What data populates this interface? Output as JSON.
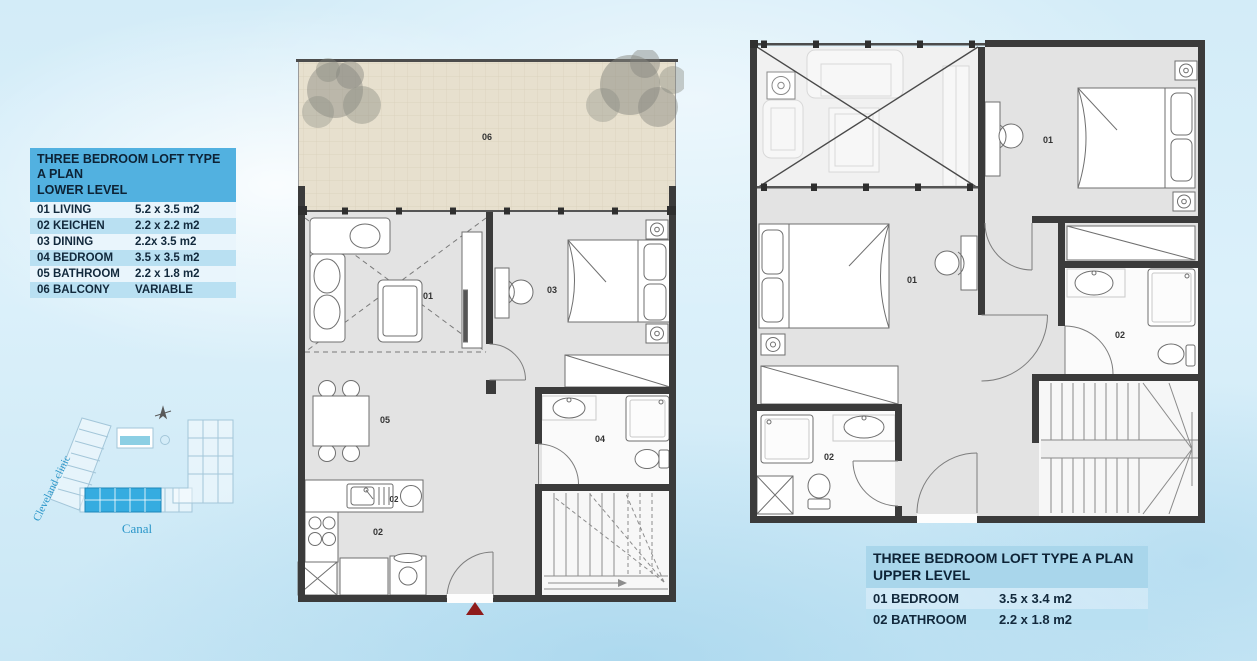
{
  "legend_lower": {
    "title_line1": "THREE BEDROOM LOFT TYPE A PLAN",
    "title_line2": "LOWER LEVEL",
    "rows": [
      {
        "label": "01 LIVING",
        "size": "5.2 x 3.5 m2"
      },
      {
        "label": "02 KEICHEN",
        "size": "2.2 x 2.2 m2"
      },
      {
        "label": "03 DINING",
        "size": "2.2x 3.5 m2"
      },
      {
        "label": "04 BEDROOM",
        "size": "3.5 x 3.5 m2"
      },
      {
        "label": "05 BATHROOM",
        "size": "2.2 x 1.8 m2"
      },
      {
        "label": "06 BALCONY",
        "size": "VARIABLE"
      }
    ]
  },
  "legend_upper": {
    "title_line1": "THREE BEDROOM LOFT TYPE A PLAN",
    "title_line2": "UPPER LEVEL",
    "rows": [
      {
        "label": "01 BEDROOM",
        "size": "3.5 x 3.4 m2"
      },
      {
        "label": "02 BATHROOM",
        "size": "2.2 x 1.8 m2"
      }
    ]
  },
  "site_map": {
    "left_label": "Cleveland clinic",
    "bottom_label": "Canal"
  },
  "lower_plan": {
    "room_labels": {
      "living": "01",
      "kitchen_counter": "02",
      "kitchen_floor": "02",
      "bedroom": "03",
      "bathroom": "04",
      "dining": "05",
      "balcony": "06"
    }
  },
  "upper_plan": {
    "room_labels": {
      "bedroom_right": "01",
      "bedroom_left": "01",
      "bathroom_right": "02",
      "bathroom_left": "02"
    }
  },
  "colors": {
    "accent_blue": "#52b1e0",
    "stripe_blue": "#b9e0f2",
    "highlight_cyan": "#35ace0",
    "entry_arrow_red": "#8e1b1b",
    "balcony_tan": "#e7e0ce",
    "wall_dark": "#3b3b3b"
  }
}
